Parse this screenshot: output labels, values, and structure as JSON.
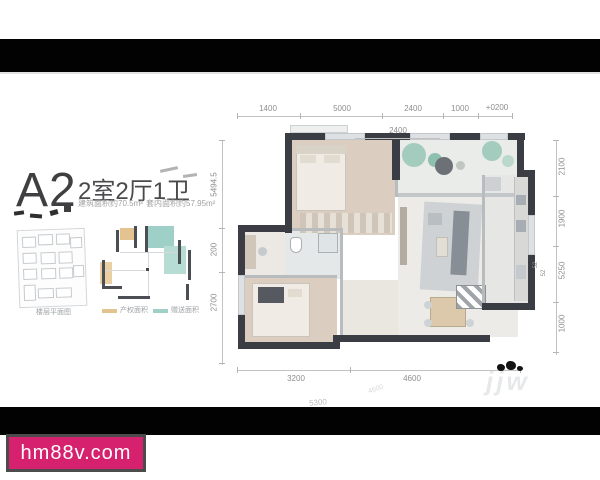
{
  "page": {
    "watermark": "hm88v.com",
    "ghost_watermark": "jjw"
  },
  "unit": {
    "code": "A2",
    "layout": "2室2厅1卫",
    "area_build": "建筑面积约70.5m²",
    "area_inner": "套内面积约57.95m²"
  },
  "panel": {
    "site_caption": "楼层平面图",
    "legend": [
      {
        "label": "产权面积",
        "color": "#e3c491"
      },
      {
        "label": "赠送面积",
        "color": "#9fd0c8"
      }
    ]
  },
  "dims": {
    "top": [
      "1400",
      "5000",
      "2400",
      "1000",
      "+0200"
    ],
    "top_inner": "2400",
    "left": [
      "5494.5",
      "200",
      "2700"
    ],
    "right": [
      "2100",
      "1900",
      "5250",
      "1000"
    ],
    "right_small": [
      "52",
      "52"
    ],
    "bottom": [
      "3200",
      "4600"
    ],
    "ghost": [
      "5300",
      "4600"
    ]
  },
  "colors": {
    "accent_pink": "#d6226e",
    "wall": "#3a3e44",
    "tan": "#e3c491",
    "teal": "#9fd0c8"
  }
}
